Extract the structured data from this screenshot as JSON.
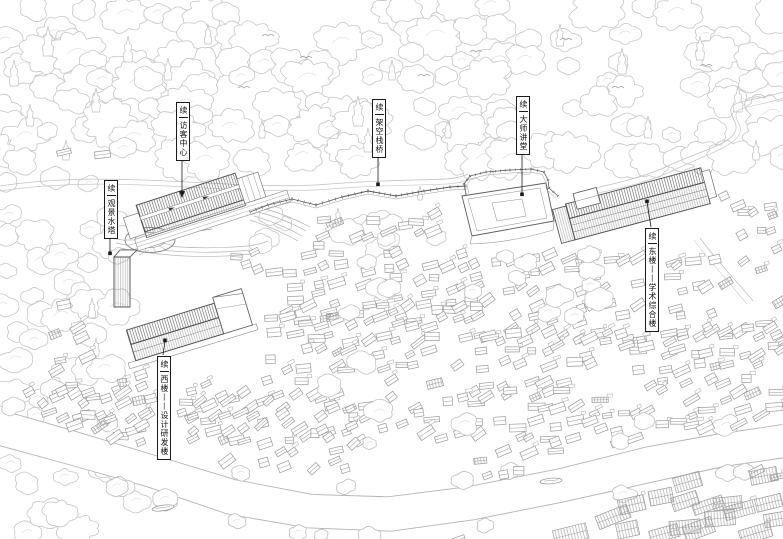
{
  "drawing": {
    "type": "architectural-site-axonometric-line-drawing",
    "background": "#ffffff"
  },
  "labels": [
    {
      "id": "visitor-center",
      "prefix": "续",
      "name": "访客中心"
    },
    {
      "id": "elevated-walkway",
      "prefix": "续",
      "name": "架空栈桥"
    },
    {
      "id": "master-lecture-hall",
      "prefix": "续",
      "name": "大师讲堂"
    },
    {
      "id": "scenic-water-tower",
      "prefix": "续",
      "name": "观景水塔"
    },
    {
      "id": "east-building",
      "prefix": "续",
      "name": "东楼——学术综合楼"
    },
    {
      "id": "west-building",
      "prefix": "续",
      "name": "西楼——设计研发楼"
    }
  ],
  "colors": {
    "background": "#ffffff",
    "tree_line": "#c6c6c6",
    "house_line": "#9a9a9a",
    "building_line": "#4a4a4a",
    "road_line": "#c2c2c2",
    "bank_line": "#b3b3b3",
    "label_ink": "#1a1a1a"
  },
  "icons": [
    {
      "name": "boat-icon"
    },
    {
      "name": "bird-icon"
    },
    {
      "name": "leader-arrow-icon"
    }
  ]
}
